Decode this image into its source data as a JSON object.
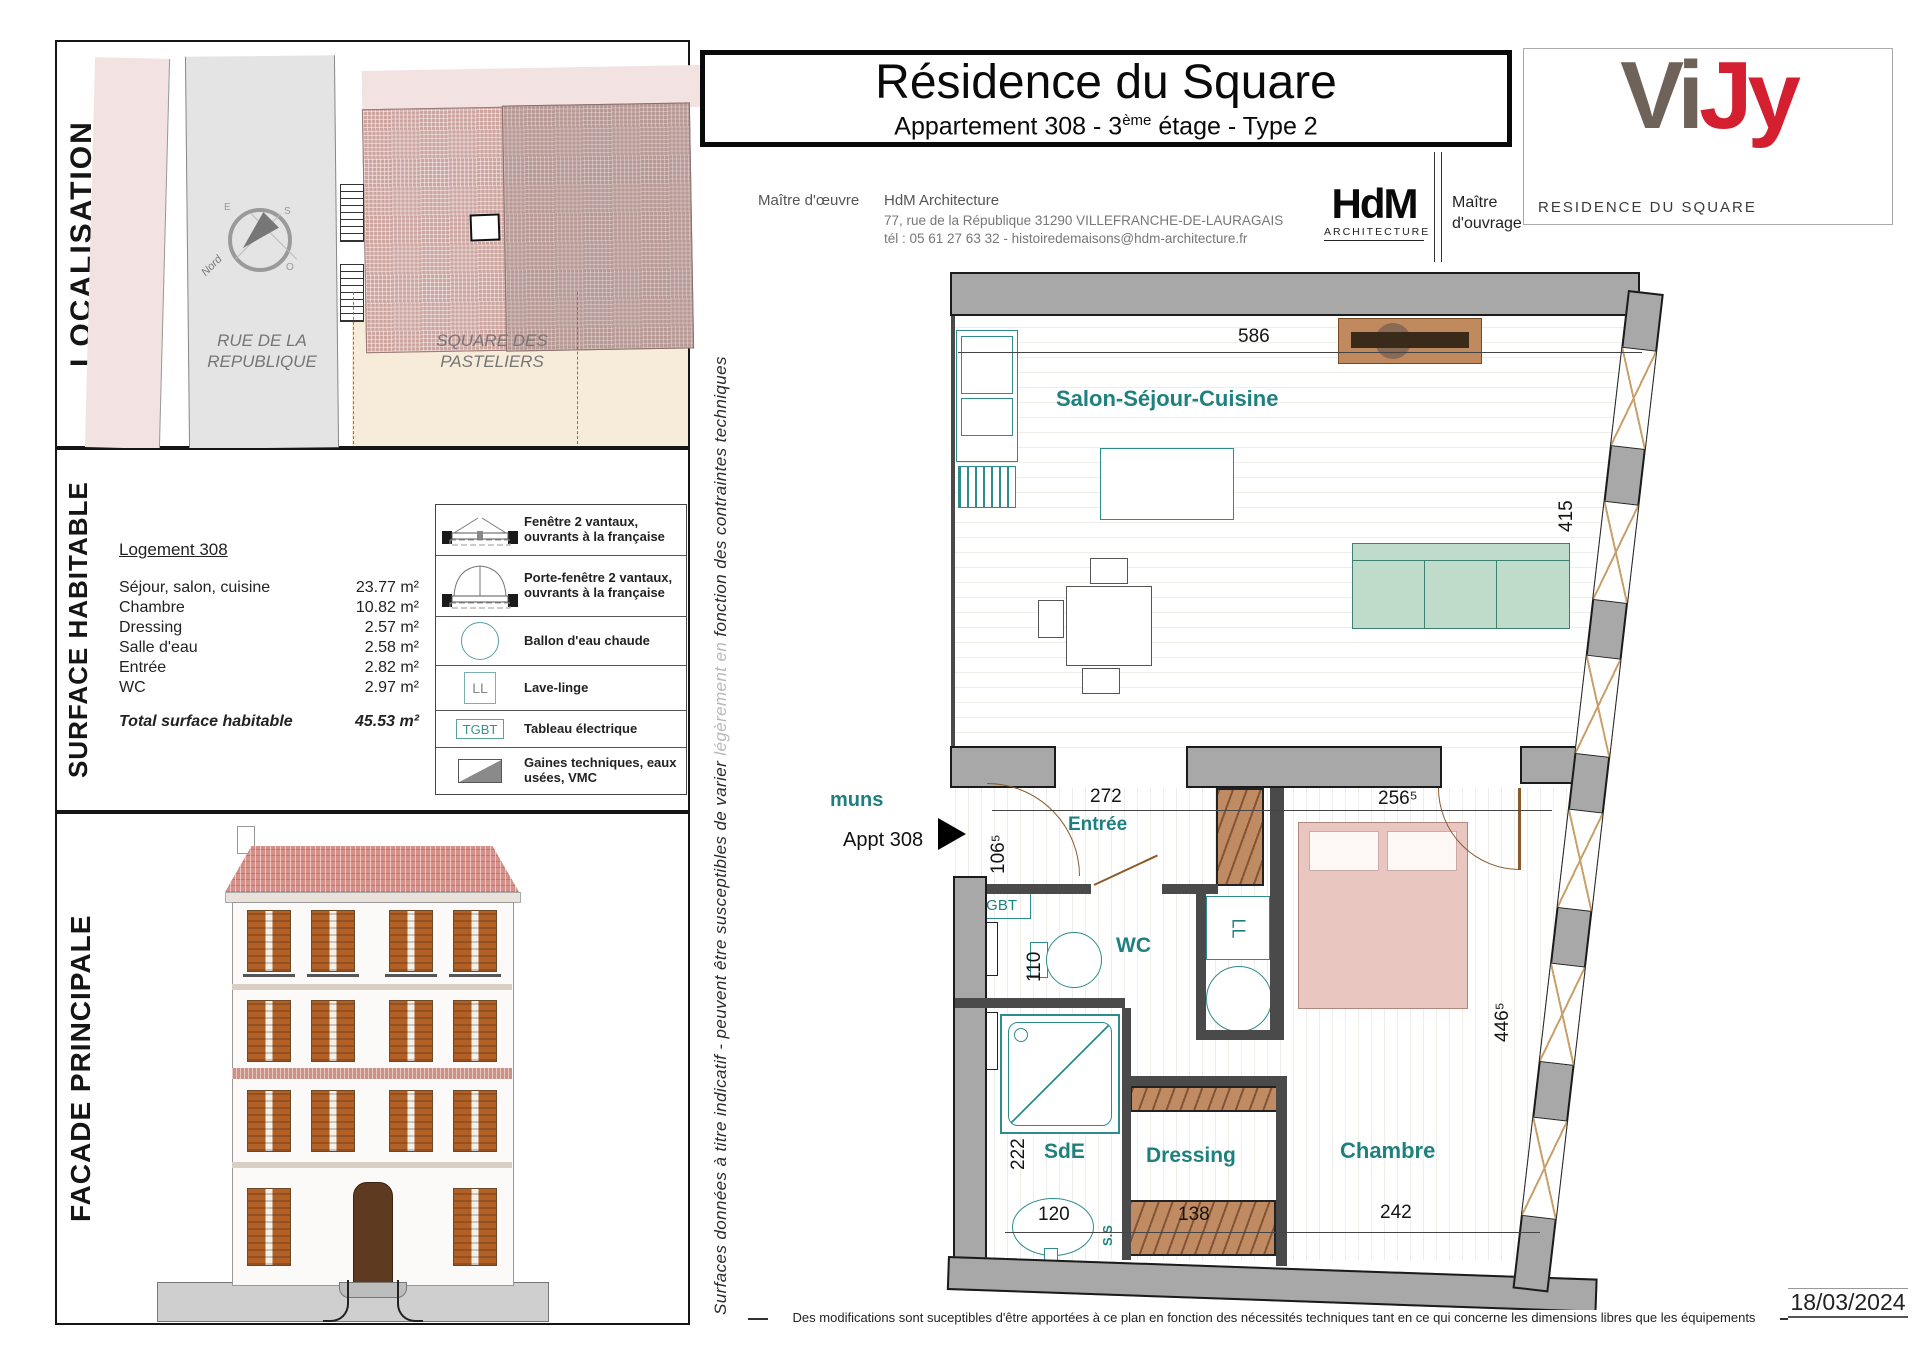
{
  "colors": {
    "accent_teal": "#1f8080",
    "brand_red": "#d41f30",
    "brand_gray": "#6e6259",
    "wall_gray": "#a8a8a8"
  },
  "header": {
    "title": "Résidence du Square",
    "subtitle_pre": "Appartement 308 - 3",
    "subtitle_sup": "ème",
    "subtitle_post": " étage - Type 2",
    "moe_label": "Maître d'œuvre",
    "moe_name": "HdM Architecture",
    "moe_address": "77, rue de la République 31290 VILLEFRANCHE-DE-LAURAGAIS",
    "moe_phone": "tél : 05 61 27 63 32 - histoiredemaisons@hdm-architecture.fr",
    "hdm_logo_text": "HdM",
    "hdm_logo_sub": "ARCHITECTURE",
    "moa_line1": "Maître",
    "moa_line2": "d'ouvrage",
    "brand_part1": "Vi",
    "brand_part2": "Jy",
    "brand_caption": "RESIDENCE DU SQUARE"
  },
  "localisation": {
    "label": "LOCALISATION",
    "street_line1": "RUE DE LA",
    "street_line2": "REPUBLIQUE",
    "square_line1": "SQUARE DES",
    "square_line2": "PASTELIERS",
    "compass": {
      "north": "Nord",
      "e": "E",
      "s": "S",
      "o": "O"
    }
  },
  "surface": {
    "label": "SURFACE HABITABLE",
    "logement": "Logement 308",
    "rows": [
      {
        "label": "Séjour, salon, cuisine",
        "value": "23.77 m²"
      },
      {
        "label": "Chambre",
        "value": "10.82 m²"
      },
      {
        "label": "Dressing",
        "value": "2.57 m²"
      },
      {
        "label": "Salle d'eau",
        "value": "2.58 m²"
      },
      {
        "label": "Entrée",
        "value": "2.82 m²"
      },
      {
        "label": "WC",
        "value": "2.97 m²"
      }
    ],
    "total_label": "Total surface habitable",
    "total_value": "45.53 m²"
  },
  "legend": {
    "items": [
      {
        "icon": "window-icon",
        "label": "Fenêtre 2 vantaux, ouvrants à la française"
      },
      {
        "icon": "french-door-icon",
        "label": "Porte-fenêtre 2 vantaux, ouvrants à la française"
      },
      {
        "icon": "water-heater-icon",
        "label": "Ballon d'eau chaude"
      },
      {
        "icon": "washer-icon",
        "symbol": "LL",
        "label": "Lave-linge"
      },
      {
        "icon": "electrical-panel-icon",
        "symbol": "TGBT",
        "label": "Tableau électrique"
      },
      {
        "icon": "ducts-icon",
        "label": "Gaines techniques, eaux usées, VMC"
      }
    ]
  },
  "facade": {
    "label": "FACADE PRINCIPALE"
  },
  "plan": {
    "rooms": {
      "salon": "Salon-Séjour-Cuisine",
      "entree": "Entrée",
      "wc": "WC",
      "sde": "SdE",
      "dressing": "Dressing",
      "chambre": "Chambre",
      "ss": "S.S"
    },
    "annotations": {
      "communs": "muns",
      "appt": "Appt 308",
      "tgbt": "TGBT",
      "ll": "LL"
    },
    "dims": {
      "salon_w": "586",
      "salon_h": "415",
      "entree_w": "272",
      "chambre_top": "256⁵",
      "entry_door": "106⁵",
      "wc_w": "110",
      "sde_h": "222",
      "sde_w": "120",
      "dressing_w": "138",
      "chambre_w": "242",
      "chambre_h": "446⁵"
    }
  },
  "side_note": {
    "part1": "Surfaces données à titre indicatif - peuvent être susceptibles de varier ",
    "part2": "légèrement en",
    "part3": " fonction des contraintes techniques"
  },
  "footer": {
    "note": "Des modifications sont suceptibles d'être apportées à ce plan en fonction des nécessités techniques tant en ce qui concerne les dimensions libres que les équipements",
    "date": "18/03/2024"
  }
}
